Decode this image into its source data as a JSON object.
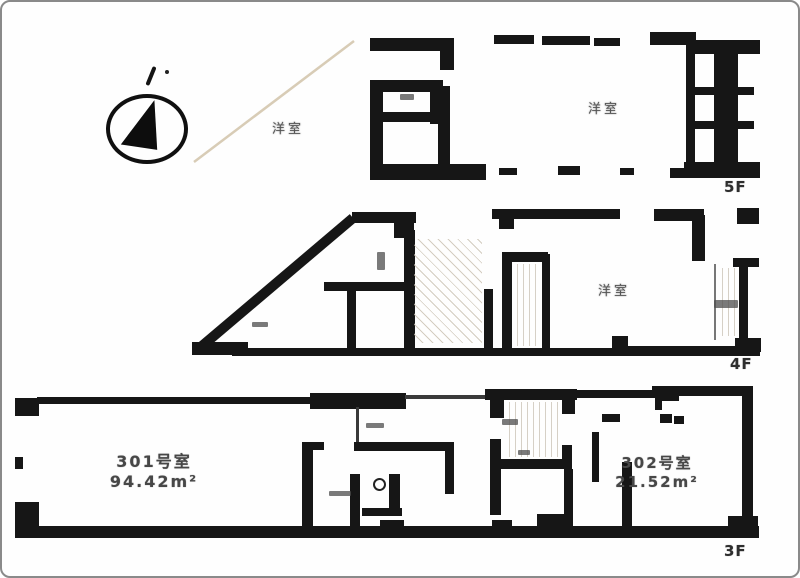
{
  "page": {
    "type": "floor-plan-scan"
  },
  "icons": {
    "compass": "north-arrow-icon"
  },
  "colors": {
    "wall": "#161616",
    "floor_label": "#2e2e2e",
    "room_label": "#555555",
    "faint_line": "#d8ccb6"
  },
  "floor_5f": {
    "label": "5F",
    "room_left": "洋室",
    "room_right": "洋室"
  },
  "floor_4f": {
    "label": "4F",
    "room": "洋室"
  },
  "floor_3f": {
    "label": "3F",
    "unit_301": {
      "name": "301号室",
      "area": "94.42m²"
    },
    "unit_302": {
      "name": "302号室",
      "area": "21.52m²"
    }
  }
}
